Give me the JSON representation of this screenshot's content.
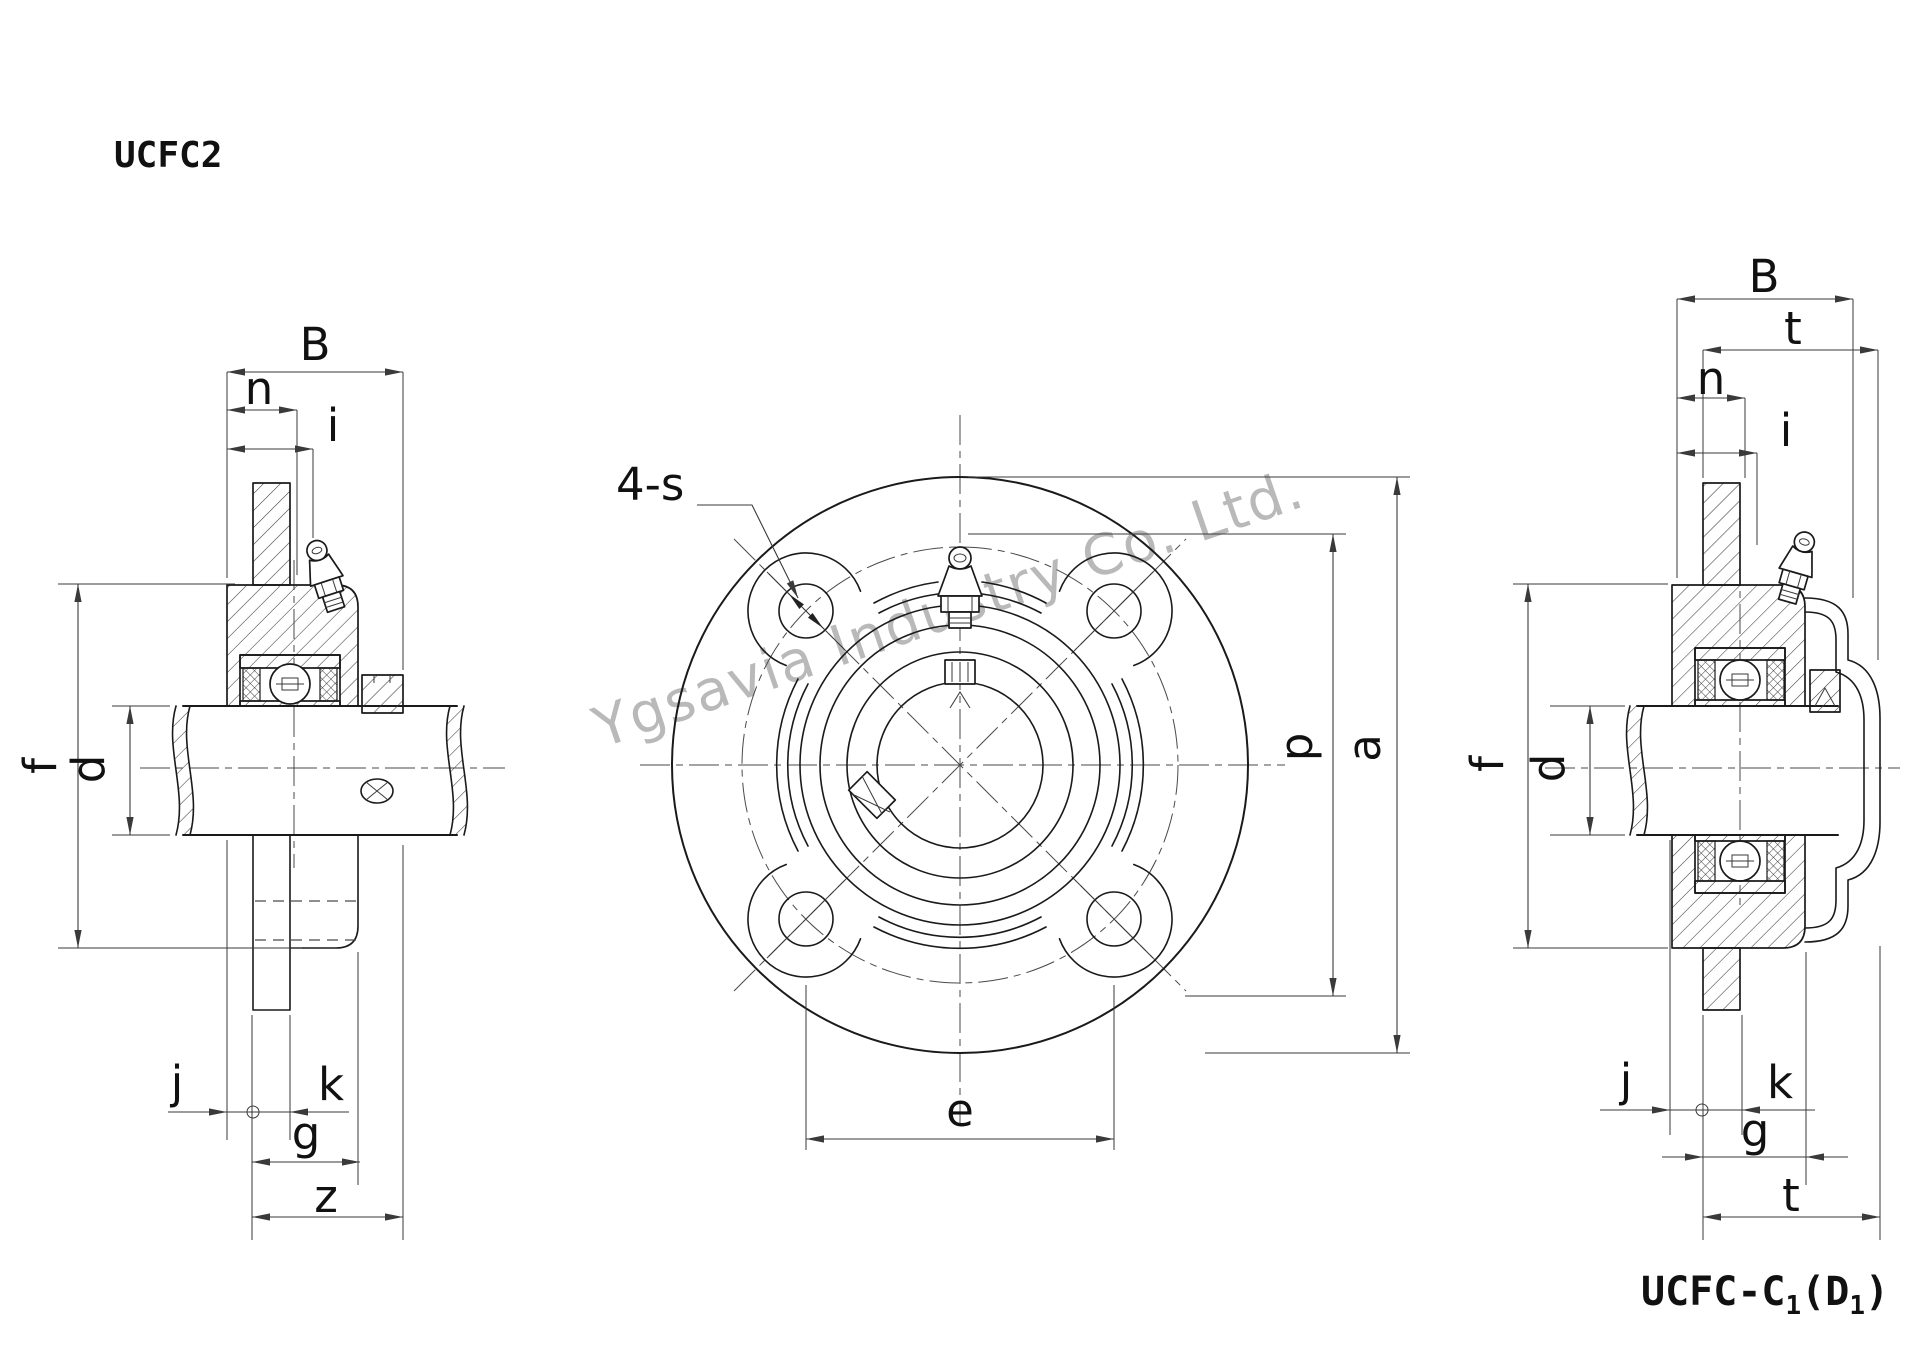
{
  "title": "UCFC2",
  "watermark": "Ygsavia Industry Co. Ltd.",
  "caption": {
    "part1": "UCFC-C",
    "sub1": "1",
    "part2": "(D",
    "sub2": "1",
    "part3": ")"
  },
  "views": {
    "left_section": {
      "dims": {
        "B": "B",
        "n": "n",
        "i": "i",
        "f": "f",
        "d": "d",
        "j": "j",
        "k": "k",
        "g": "g",
        "z": "z"
      }
    },
    "front": {
      "bolt_holes_label": "4-s",
      "dims": {
        "e": "e",
        "p": "p",
        "a": "a"
      }
    },
    "right_section": {
      "dims": {
        "B": "B",
        "t_top": "t",
        "n": "n",
        "i": "i",
        "f": "f",
        "d": "d",
        "j": "j",
        "k": "k",
        "g": "g",
        "t_bottom": "t"
      }
    }
  },
  "colors": {
    "line": "#1a1a1a",
    "watermark": "#b9b9b9",
    "background": "#ffffff"
  }
}
